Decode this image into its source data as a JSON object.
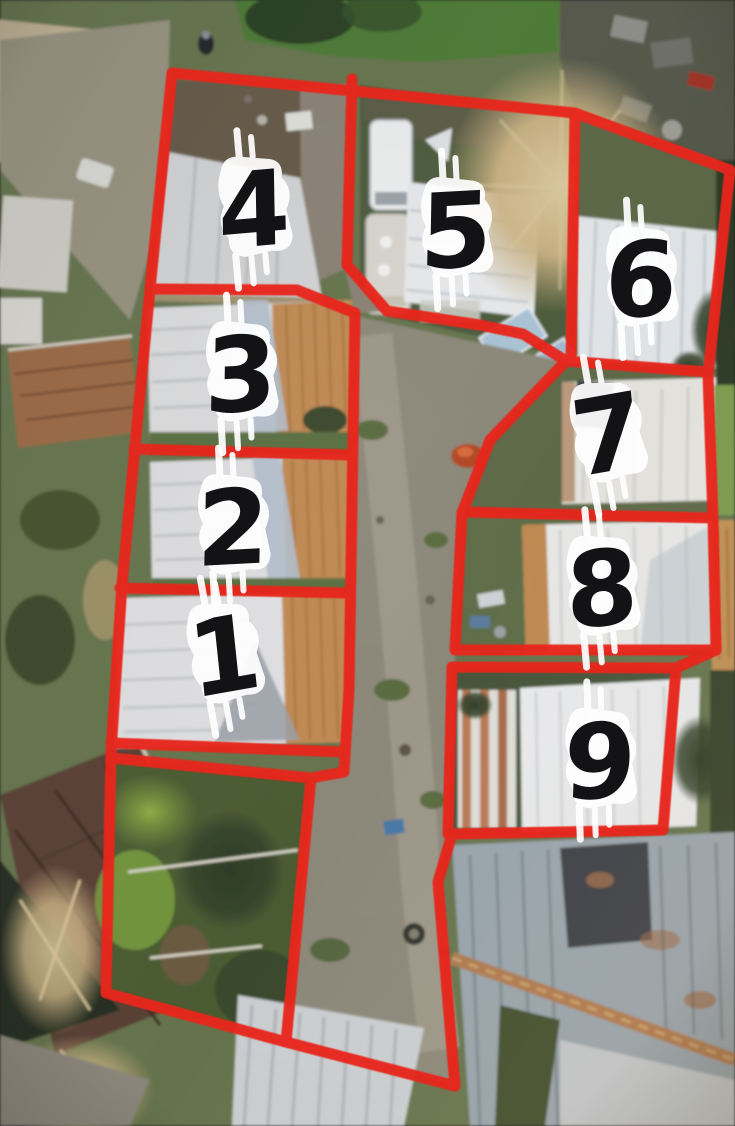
{
  "scene": {
    "description": "Aerial drone photo of a property subdivided into nine lots outlined in red, numbered 1-9, with a central dirt driveway",
    "colors": {
      "outline_red": "#e8251d",
      "number_fill": "#131316",
      "brush_mark": "#ffffff"
    },
    "lots": [
      {
        "number": "1"
      },
      {
        "number": "2"
      },
      {
        "number": "3"
      },
      {
        "number": "4"
      },
      {
        "number": "5"
      },
      {
        "number": "6"
      },
      {
        "number": "7"
      },
      {
        "number": "8"
      },
      {
        "number": "9"
      }
    ]
  }
}
